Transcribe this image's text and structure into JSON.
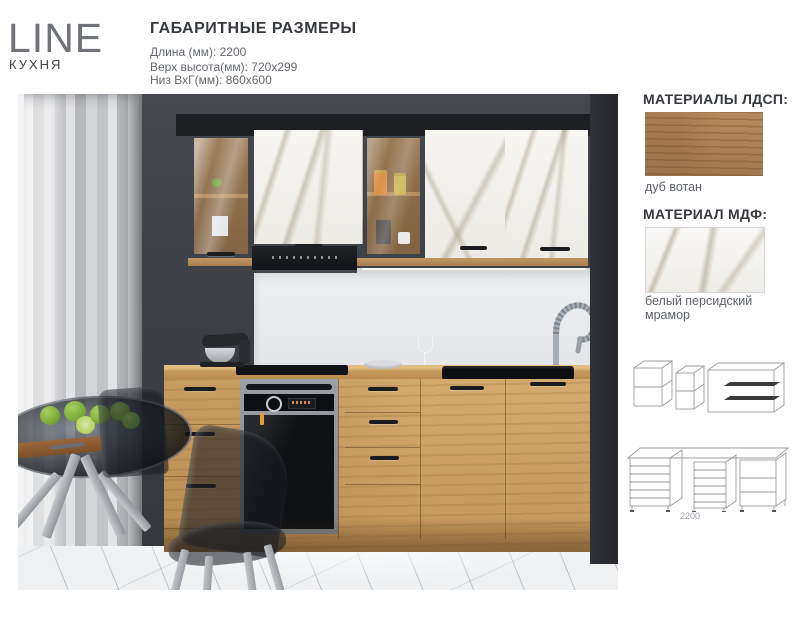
{
  "header": {
    "brand": "LINE",
    "brand_subtitle": "КУХНЯ",
    "dimensions_title": "ГАБАРИТНЫЕ РАЗМЕРЫ",
    "dimension_lines": [
      "Длина (мм): 2200",
      "Верх высота(мм): 720x299",
      "Низ ВхГ(мм): 860x600"
    ]
  },
  "materials": {
    "ldsp_heading": "МАТЕРИАЛЫ ЛДСП:",
    "ldsp_name": "дуб вотан",
    "mdf_heading": "МАТЕРИАЛ МДФ:",
    "mdf_name": "белый персидский мрамор"
  },
  "drawings": {
    "length_label": "2200"
  },
  "colors": {
    "brand_gray": "#6f7378",
    "heading_dark": "#36393d",
    "body_text": "#5c6066",
    "oak": "#c79a5e",
    "marble": "#f3f1ee",
    "wall_dark": "#3a3d43",
    "appliance_black": "#17181b"
  }
}
